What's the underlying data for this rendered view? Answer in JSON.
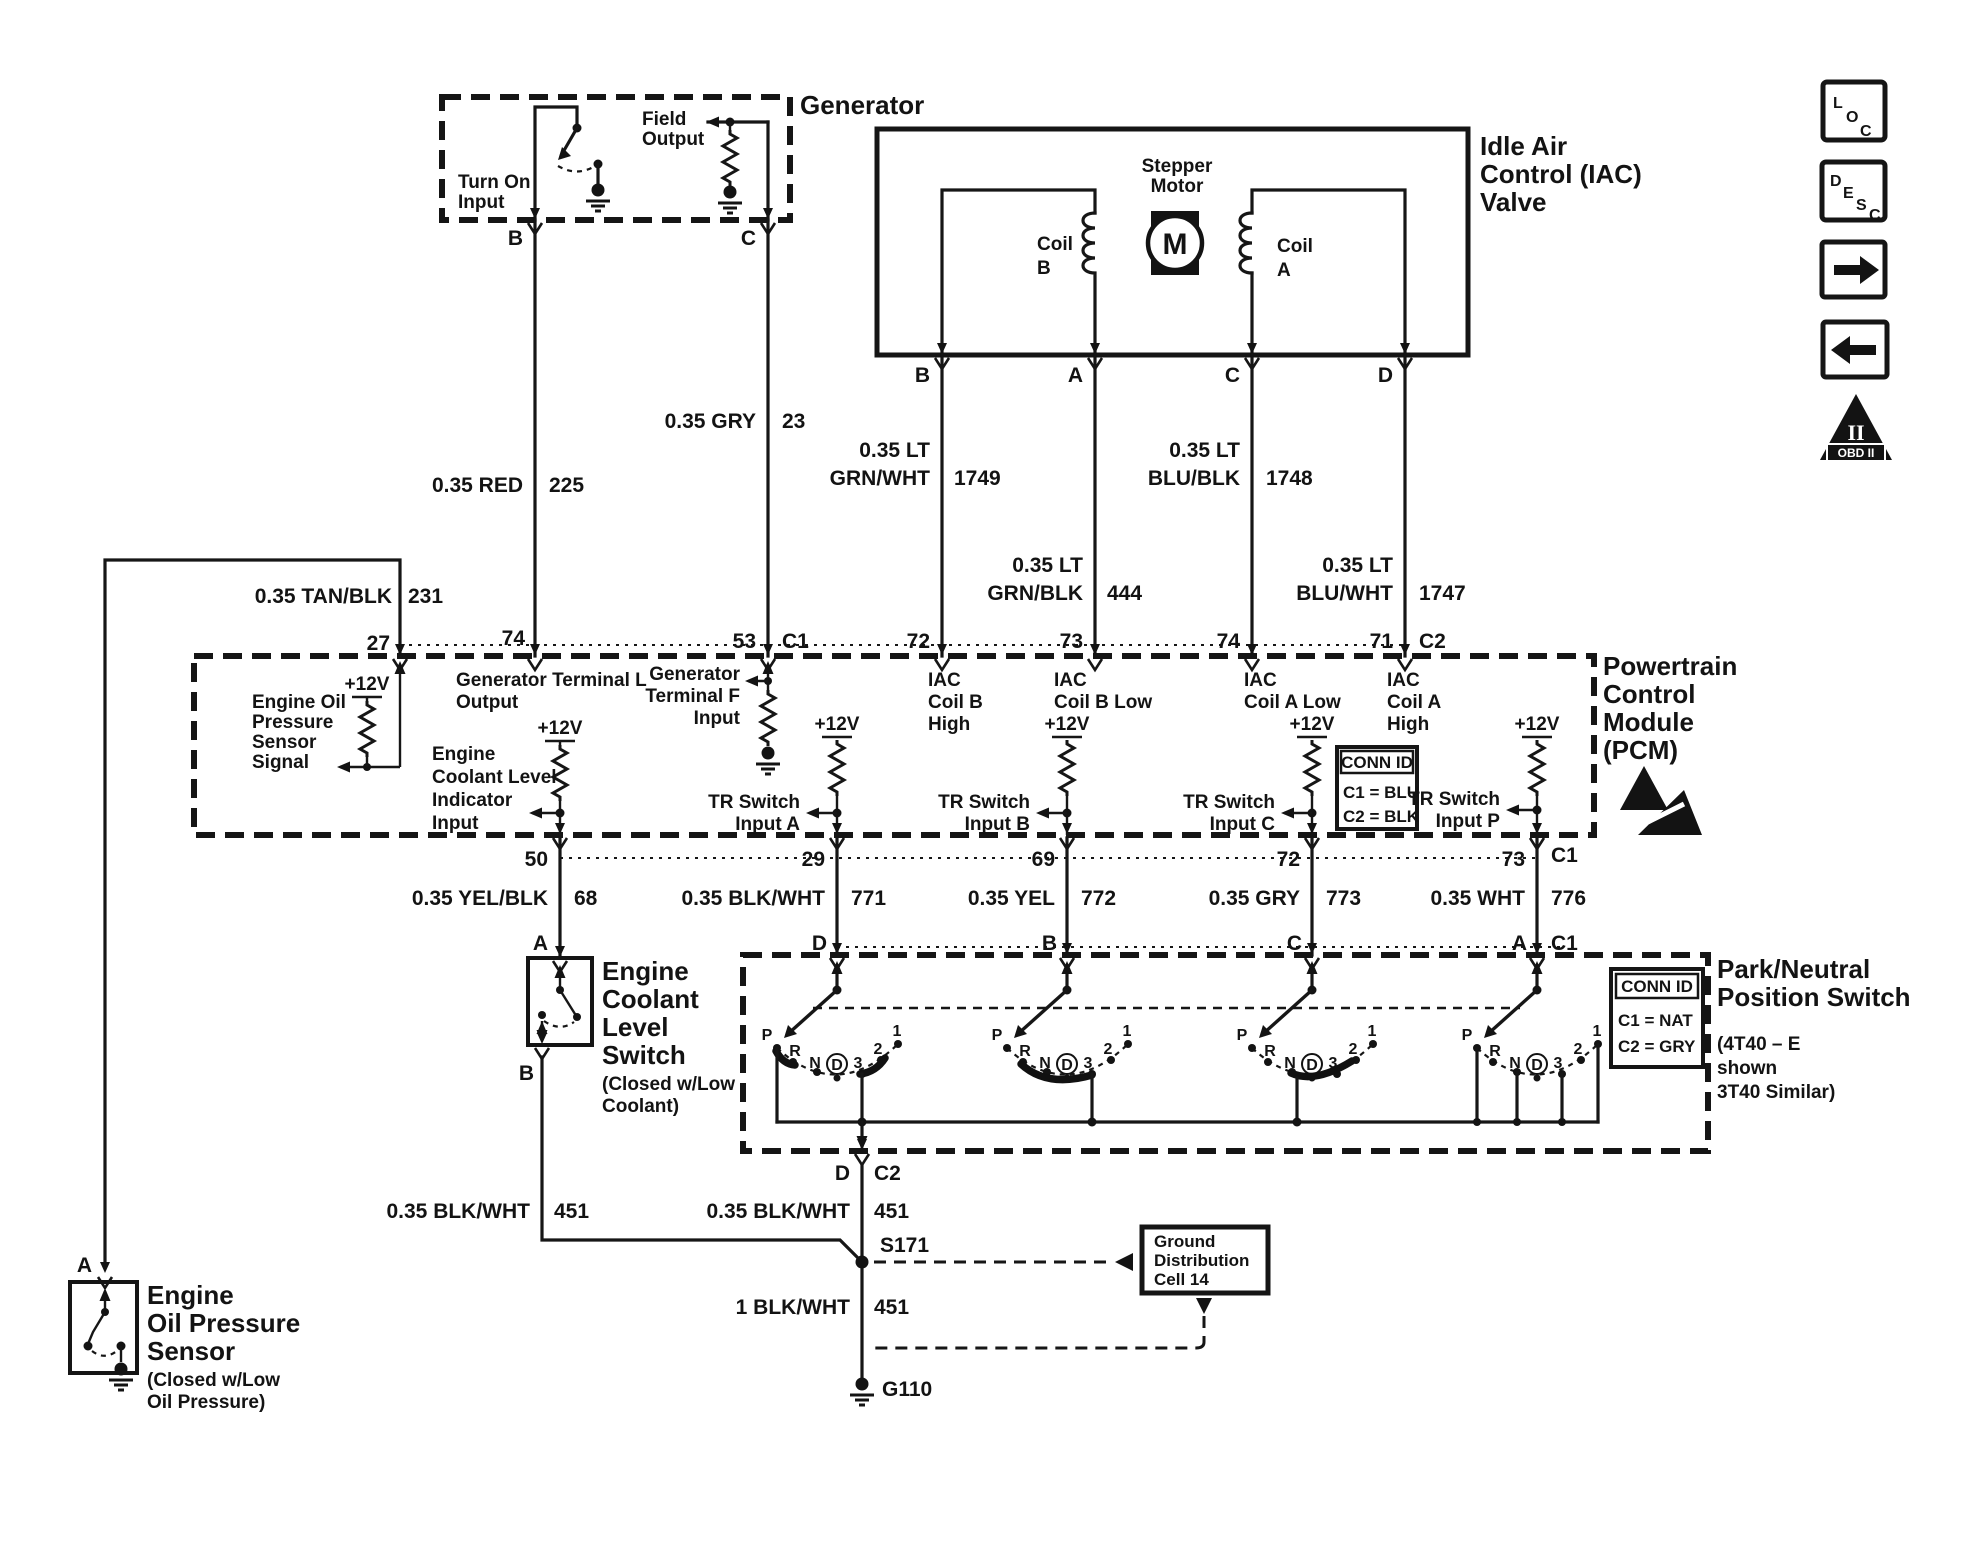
{
  "generator": {
    "title": "Generator",
    "turn_on_1": "Turn On",
    "turn_on_2": "Input",
    "field_1": "Field",
    "field_2": "Output",
    "term_b": "B",
    "term_c": "C"
  },
  "iac": {
    "title_1": "Idle Air",
    "title_2": "Control (IAC)",
    "title_3": "Valve",
    "stepper_1": "Stepper",
    "stepper_2": "Motor",
    "motor": "M",
    "coil": "Coil",
    "coil_b": "B",
    "coil_a": "A",
    "term_b": "B",
    "term_a": "A",
    "term_c": "C",
    "term_d": "D"
  },
  "wires": {
    "lt": "0.35 LT",
    "red": {
      "label": "0.35 RED",
      "circuit": "225"
    },
    "gry": {
      "label": "0.35 GRY",
      "circuit": "23"
    },
    "tan": {
      "label": "0.35 TAN/BLK",
      "circuit": "231"
    },
    "grnwht": {
      "color": "GRN/WHT",
      "circuit": "1749"
    },
    "blublk": {
      "color": "BLU/BLK",
      "circuit": "1748"
    },
    "grnblk": {
      "color": "GRN/BLK",
      "circuit": "444"
    },
    "bluwht": {
      "color": "BLU/WHT",
      "circuit": "1747"
    },
    "yelblk": {
      "label": "0.35 YEL/BLK",
      "circuit": "68"
    },
    "blkwht771": {
      "label": "0.35 BLK/WHT",
      "circuit": "771"
    },
    "yel772": {
      "label": "0.35 YEL",
      "circuit": "772"
    },
    "gry773": {
      "label": "0.35 GRY",
      "circuit": "773"
    },
    "wht776": {
      "label": "0.35 WHT",
      "circuit": "776"
    },
    "blkwht451a": {
      "label": "0.35 BLK/WHT",
      "circuit": "451"
    },
    "blkwht451b": {
      "label": "0.35 BLK/WHT",
      "circuit": "451"
    },
    "blkwht451c": {
      "label": "1 BLK/WHT",
      "circuit": "451"
    }
  },
  "pcm": {
    "title_1": "Powertrain",
    "title_2": "Control",
    "title_3": "Module",
    "title_4": "(PCM)",
    "v12": "+12V",
    "tr": "TR Switch",
    "tr_a": "Input A",
    "tr_b": "Input B",
    "tr_c": "Input C",
    "tr_p": "Input P",
    "pins_top": {
      "p27": "27",
      "p74a": "74",
      "p53": "53",
      "c1": "C1",
      "p72": "72",
      "p73": "73",
      "p74b": "74",
      "p71": "71",
      "c2": "C2"
    },
    "pins_bottom": {
      "p50": "50",
      "p29": "29",
      "p69": "69",
      "p72": "72",
      "p73": "73",
      "c1": "C1"
    },
    "oil_sig": [
      "Engine Oil",
      "Pressure",
      "Sensor",
      "Signal"
    ],
    "gtl": [
      "Generator Terminal L",
      "Output"
    ],
    "ecl": [
      "Engine",
      "Coolant Level",
      "Indicator",
      "Input"
    ],
    "gtf": [
      "Generator",
      "Terminal F",
      "Input"
    ],
    "iac_bh": [
      "IAC",
      "Coil B",
      "High"
    ],
    "iac_bl": [
      "IAC",
      "Coil B Low"
    ],
    "iac_al": [
      "IAC",
      "Coil A Low"
    ],
    "iac_ah": [
      "IAC",
      "Coil A",
      "High"
    ],
    "connid": {
      "title": "CONN ID",
      "c1": "C1 = BLU",
      "c2": "C2 = BLK"
    }
  },
  "pns": {
    "title_1": "Park/Neutral",
    "title_2": "Position Switch",
    "note_1": "(4T40 – E",
    "note_2": "shown",
    "note_3": "3T40 Similar)",
    "term_d": "D",
    "term_b": "B",
    "term_c": "C",
    "term_a": "A",
    "term_a_conn": "C1",
    "out_d": "D",
    "out_c2": "C2",
    "gear": [
      "P",
      "R",
      "N",
      "D",
      "3",
      "2",
      "1"
    ],
    "connid": {
      "title": "CONN ID",
      "c1": "C1 = NAT",
      "c2": "C2 = GRY"
    }
  },
  "coolant": {
    "term_a": "A",
    "term_b": "B",
    "name": [
      "Engine",
      "Coolant",
      "Level",
      "Switch"
    ],
    "note": [
      "(Closed w/Low",
      "Coolant)"
    ]
  },
  "oil": {
    "term_a": "A",
    "name": [
      "Engine",
      "Oil Pressure",
      "Sensor"
    ],
    "note": [
      "(Closed w/Low",
      "Oil Pressure)"
    ]
  },
  "ground": {
    "splice": "S171",
    "gnd": "G110",
    "cell": [
      "Ground",
      "Distribution",
      "Cell 14"
    ]
  },
  "icons": {
    "loc": [
      "L",
      "O",
      "C"
    ],
    "desc": [
      "D",
      "E",
      "S",
      "C"
    ],
    "obd_ii": "II",
    "obd_label": "OBD II"
  }
}
